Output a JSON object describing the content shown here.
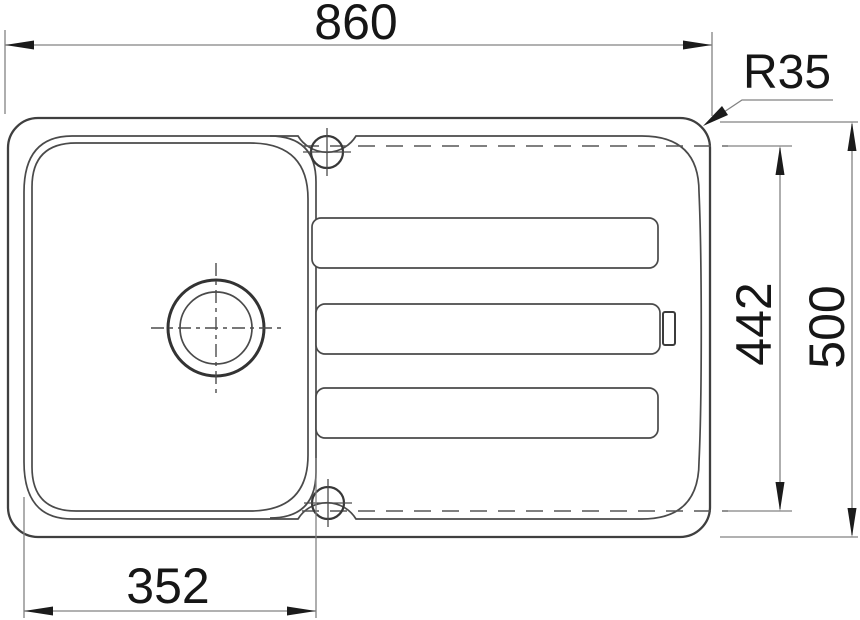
{
  "drawing": {
    "dimensions": {
      "overall_width": "860",
      "corner_radius": "R35",
      "inner_depth": "442",
      "overall_depth": "500",
      "bowl_width": "352"
    },
    "colors": {
      "background": "#ffffff",
      "ink": "#3f3f3f",
      "dimension_line": "#828282",
      "text": "#161616"
    }
  }
}
